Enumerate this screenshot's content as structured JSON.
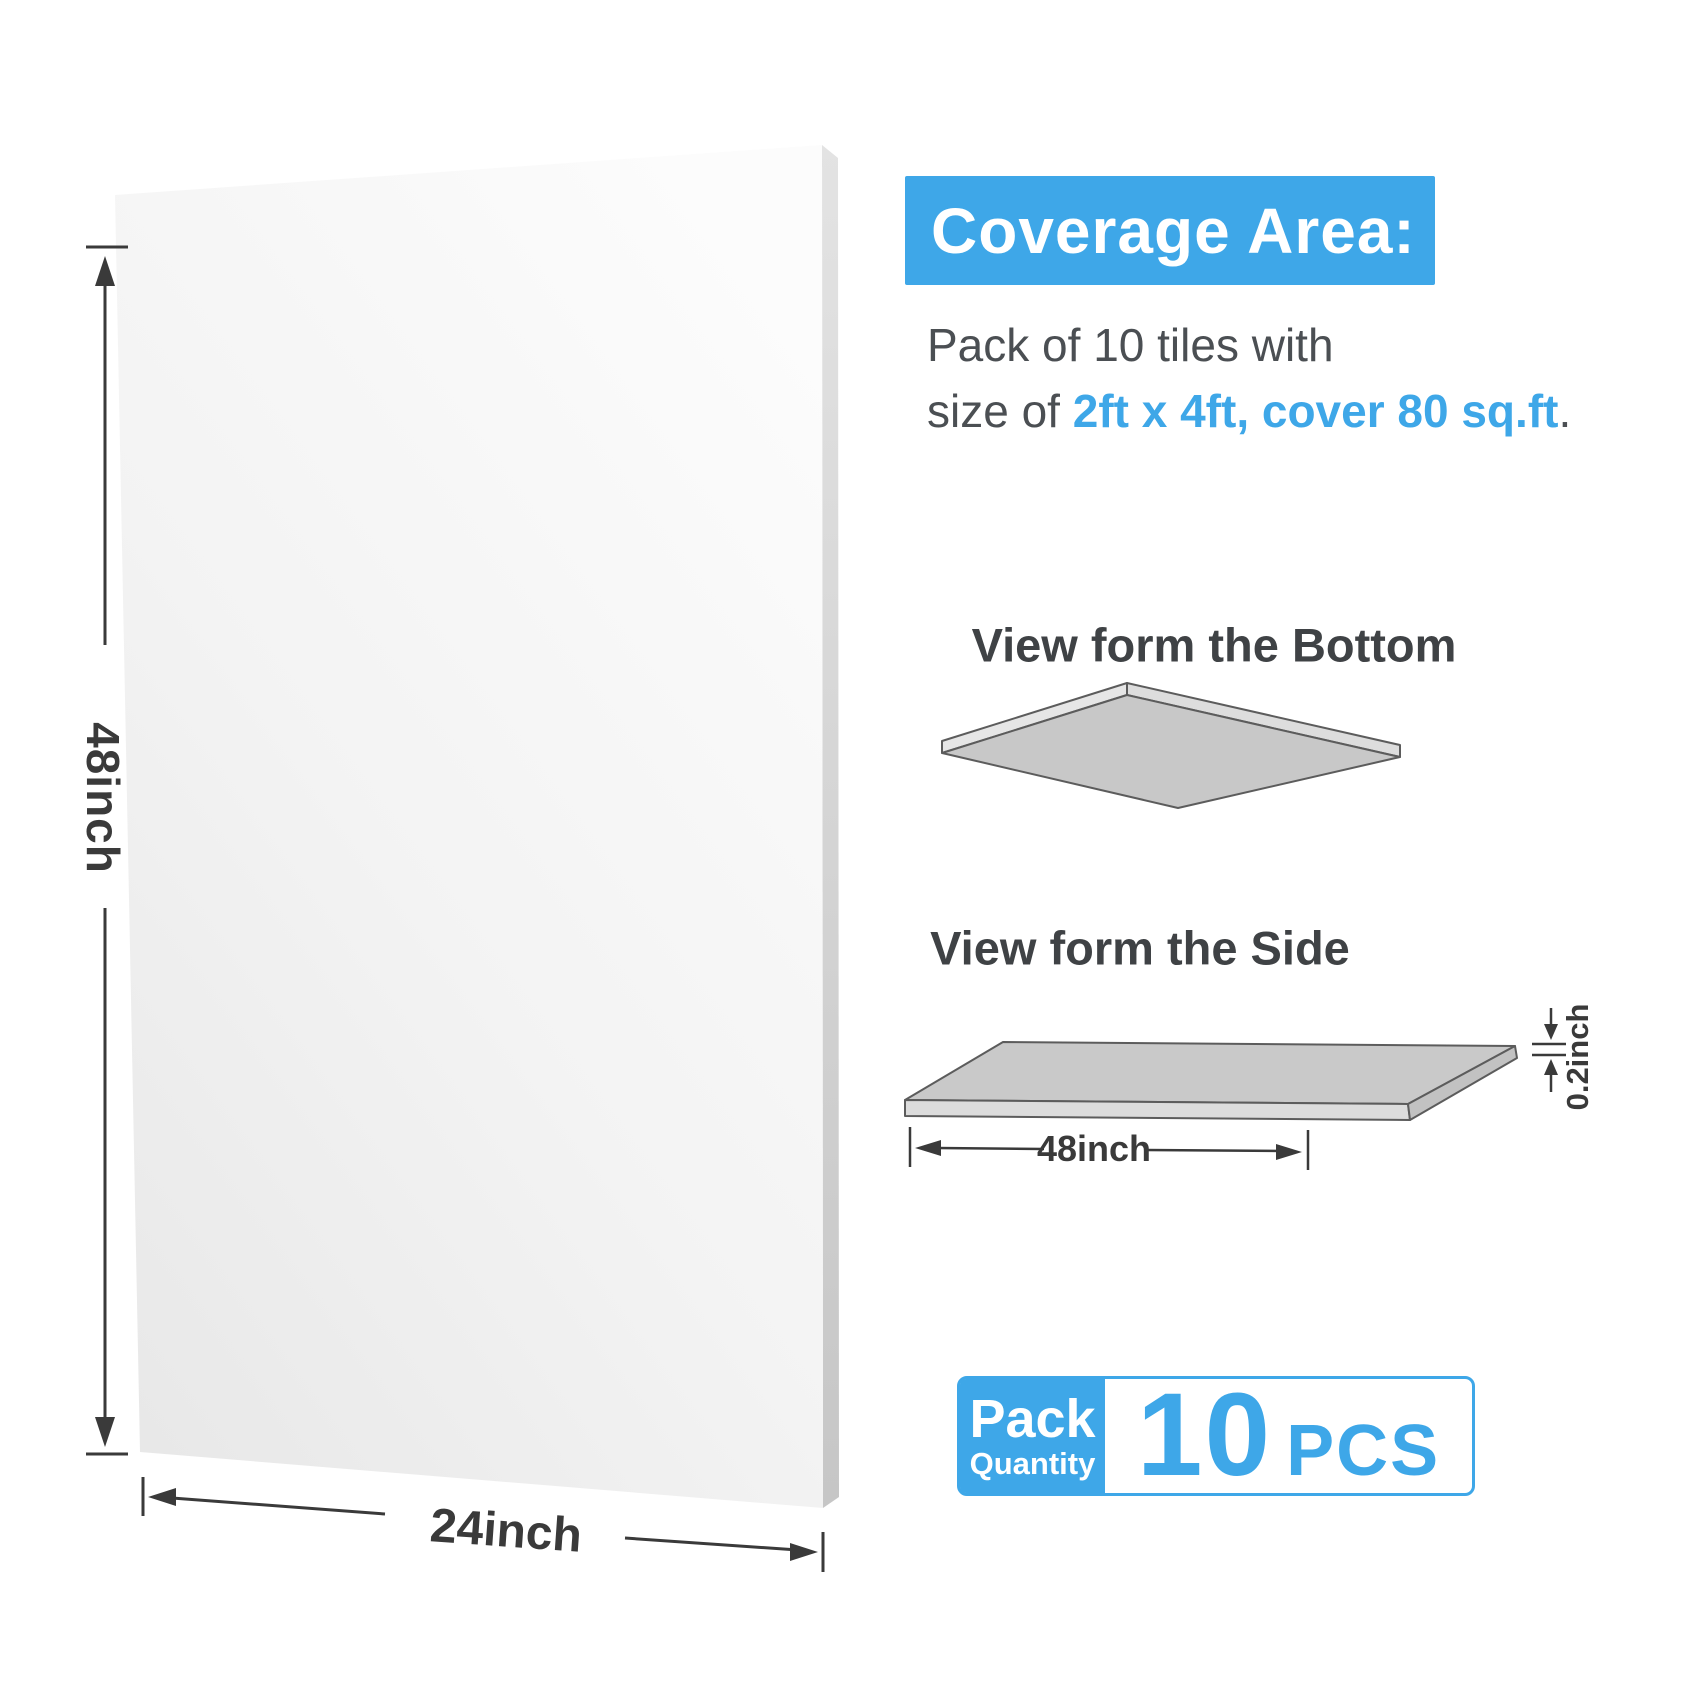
{
  "colors": {
    "accent_blue": "#3EA7E8",
    "heading_text": "#3F4245",
    "body_text": "#4B4F53",
    "dimension_text": "#3A3A3A",
    "sheet_gray": "#C8C8C8",
    "panel_face_light": "#FCFCFC",
    "panel_face_shade": "#E9E9E9"
  },
  "main_panel": {
    "height_label": "48inch",
    "width_label": "24inch"
  },
  "coverage": {
    "title": "Coverage Area:",
    "line1": "Pack of 10 tiles with",
    "line2_prefix": "size of ",
    "line2_highlight": "2ft x 4ft, cover 80 sq.ft",
    "line2_suffix": "."
  },
  "views": {
    "bottom": {
      "title": "View form the Bottom"
    },
    "side": {
      "title": "View form the Side",
      "width_label": "48inch",
      "thickness_label": "0.2inch"
    }
  },
  "pack": {
    "label_top": "Pack",
    "label_bottom": "Quantity",
    "count": "10",
    "unit": "PCS"
  }
}
